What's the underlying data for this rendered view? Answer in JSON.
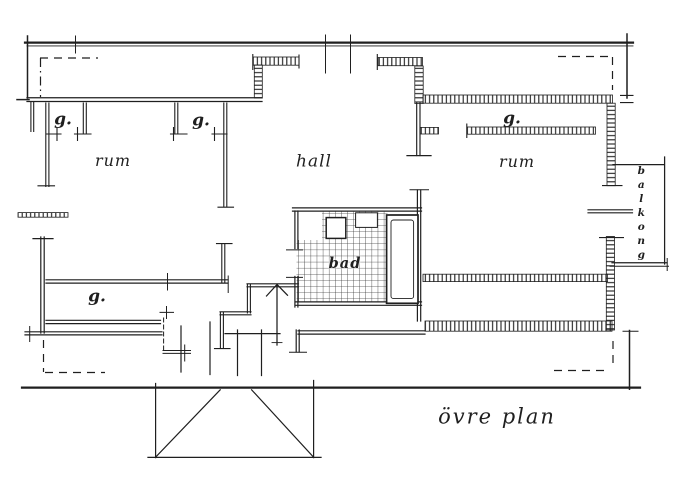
{
  "drawing": {
    "title": "övre plan",
    "labels": {
      "room_left": "rum",
      "room_right": "rum",
      "hall": "hall",
      "bath": "bad",
      "balcony": "balkong",
      "closet_top_left_1": "g.",
      "closet_top_left_2": "g.",
      "closet_top_right": "g.",
      "closet_lower_left": "g."
    },
    "colors": {
      "ink": "#1f1f1f",
      "paper": "#ffffff"
    }
  }
}
